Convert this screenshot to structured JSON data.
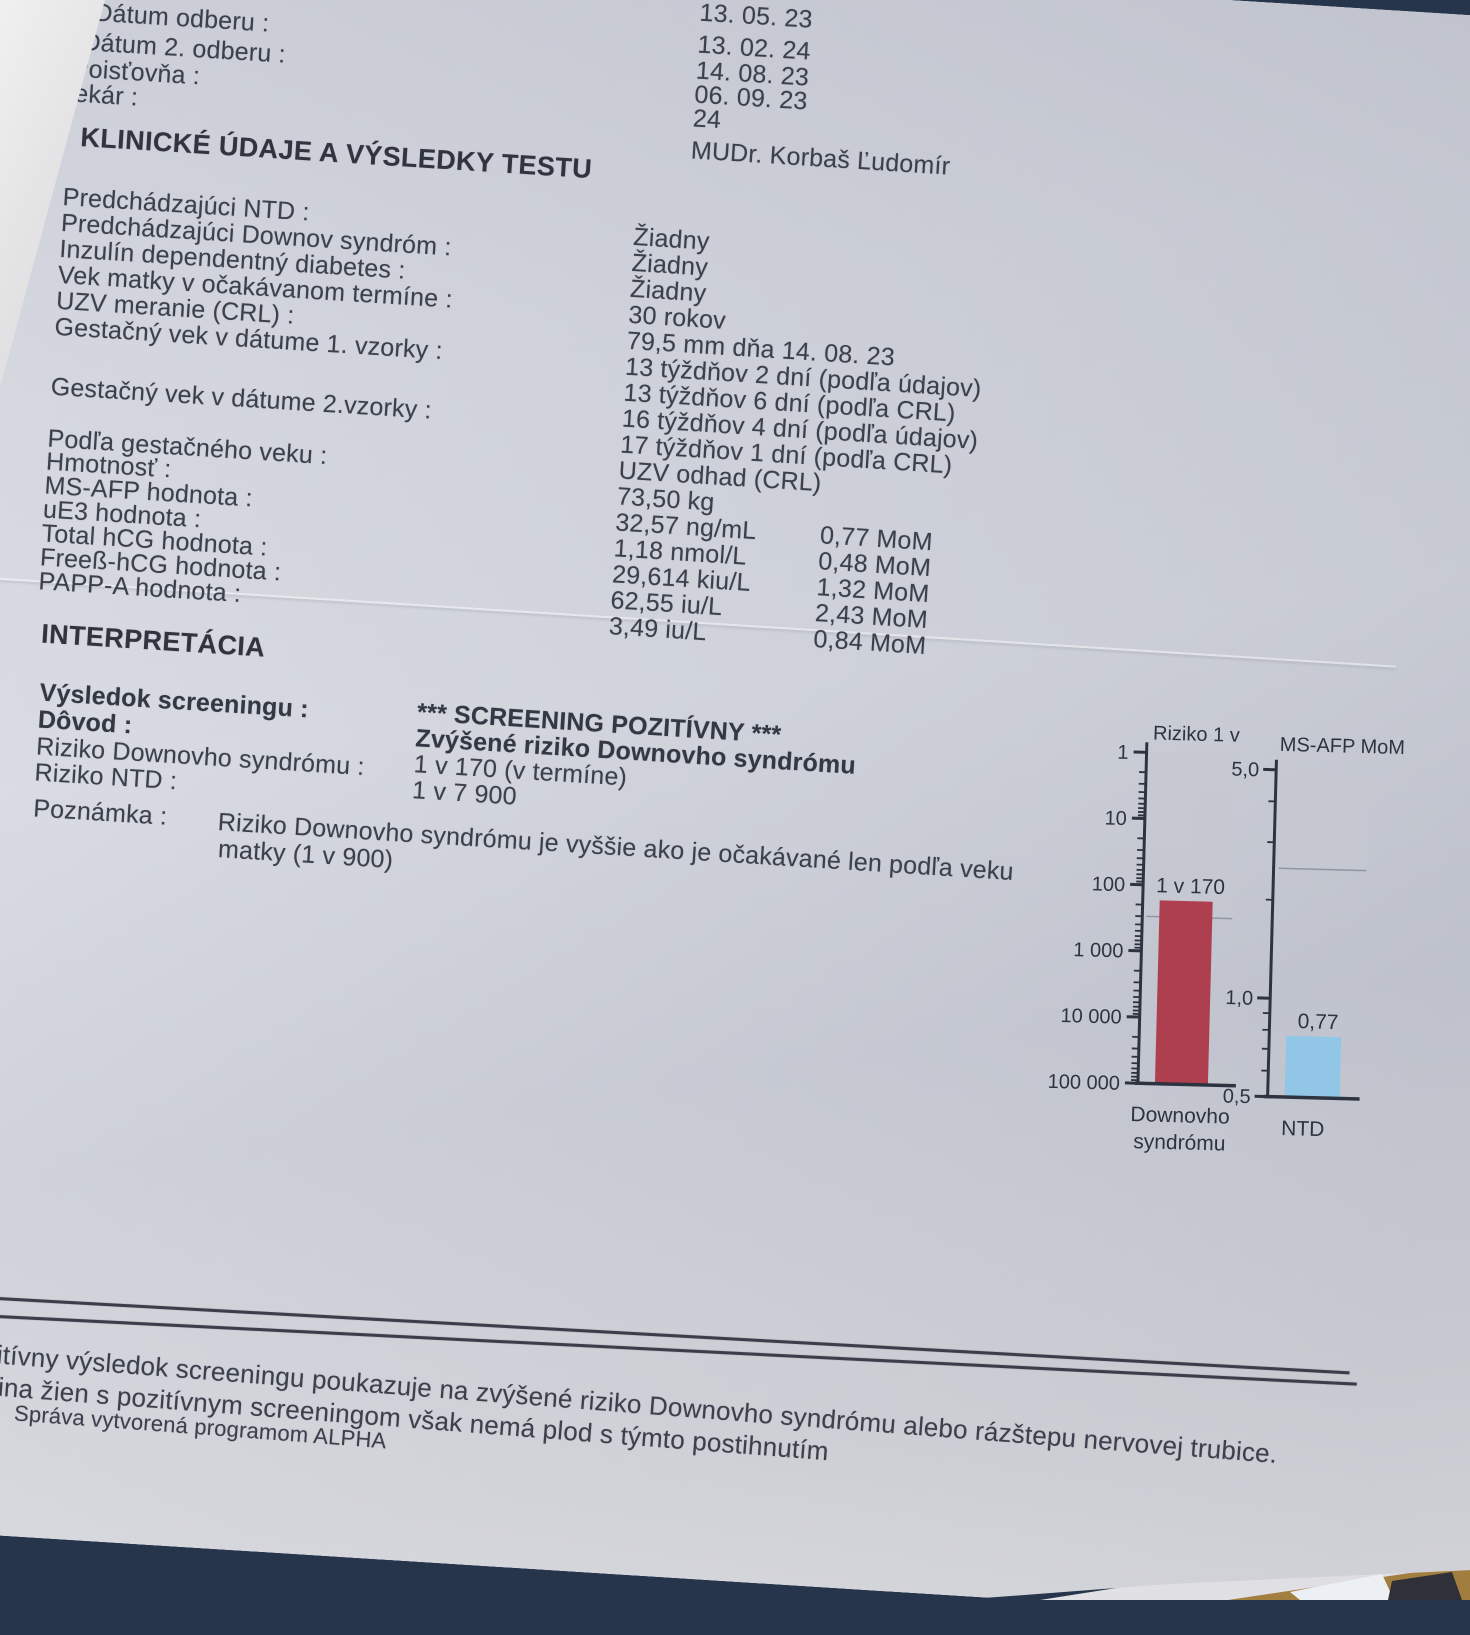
{
  "header": {
    "field_labels": [
      "Dátum odberu :",
      "Dátum 2. odberu :",
      "Poisťovňa :",
      "Lekár :"
    ],
    "field_values": [
      "13. 05. 23",
      "13. 02. 24",
      "14. 08. 23",
      "06. 09. 23",
      "24",
      "MUDr. Korbaš Ľudomír"
    ]
  },
  "clinical": {
    "section_title": "KLINICKÉ ÚDAJE A VÝSLEDKY TESTU",
    "labels": [
      "Predchádzajúci NTD :",
      "Predchádzajúci Downov syndróm :",
      "Inzulín dependentný diabetes :",
      "Vek matky v očakávanom termíne :",
      "UZV meranie (CRL) :",
      "Gestačný vek v dátume 1. vzorky :",
      "Gestačný vek v dátume 2.vzorky :",
      "Podľa gestačného veku :",
      "Hmotnosť :",
      "MS-AFP hodnota :",
      "uE3 hodnota :",
      "Total hCG hodnota :",
      "Freeß-hCG hodnota :",
      "PAPP-A hodnota :"
    ],
    "values": [
      "Žiadny",
      "Žiadny",
      "Žiadny",
      "30 rokov",
      "79,5 mm dňa 14. 08. 23",
      "13 týždňov 2 dní (podľa údajov)",
      "13 týždňov 6 dní (podľa CRL)",
      "16 týždňov 4 dní (podľa údajov)",
      "17 týždňov 1 dní (podľa CRL)",
      "UZV odhad (CRL)",
      "73,50 kg",
      "32,57 ng/mL",
      "1,18 nmol/L",
      "29,614 kiu/L",
      "62,55 iu/L",
      "3,49 iu/L"
    ],
    "mom_values": [
      "0,77 MoM",
      "0,48 MoM",
      "1,32 MoM",
      "2,43 MoM",
      "0,84 MoM"
    ]
  },
  "interpretation": {
    "section_title": "INTERPRETÁCIA",
    "row_labels": [
      "Výsledok screeningu :",
      "Dôvod :",
      "Riziko Downovho syndrómu :",
      "Riziko NTD :"
    ],
    "row_values": [
      "*** SCREENING POZITÍVNY ***",
      "Zvýšené riziko Downovho syndrómu",
      "1 v 170 (v termíne)",
      "1 v 7 900"
    ],
    "note_label": "Poznámka :",
    "note_line1": "Riziko Downovho syndrómu je vyššie ako je očakávané len podľa veku",
    "note_line2": "matky (1 v 900)"
  },
  "chart_data": [
    {
      "type": "bar",
      "title": "Riziko  1 v",
      "categories": [
        "Downovho syndrómu"
      ],
      "values": [
        170
      ],
      "value_labels": [
        "1 v 170"
      ],
      "scale": "log",
      "axis_range": [
        1,
        100000
      ],
      "ticks": [
        {
          "v": 1,
          "label": "1"
        },
        {
          "v": 10,
          "label": "10"
        },
        {
          "v": 100,
          "label": "100"
        },
        {
          "v": 1000,
          "label": "1 000"
        },
        {
          "v": 10000,
          "label": "10 000"
        },
        {
          "v": 100000,
          "label": "100 000"
        }
      ],
      "shaded_region": [
        1,
        300
      ],
      "baseline": 100000,
      "bar_color": "#ae3f4e",
      "shade_color": "#c5c8d1",
      "xlabel_lines": [
        "Downovho",
        "syndrómu"
      ]
    },
    {
      "type": "bar",
      "title": "MS-AFP MoM",
      "categories": [
        "NTD"
      ],
      "values": [
        0.77
      ],
      "value_labels": [
        "0,77"
      ],
      "scale": "log",
      "axis_range": [
        5,
        0.5
      ],
      "ticks": [
        {
          "v": 5,
          "label": "5,0"
        },
        {
          "v": 1,
          "label": "1,0"
        },
        {
          "v": 0.5,
          "label": "0,5"
        }
      ],
      "shaded_region": [
        5,
        2.5
      ],
      "baseline": 0.5,
      "bar_color": "#92c6e6",
      "shade_color": "#c5c8d1",
      "xlabel_lines": [
        "NTD"
      ]
    }
  ],
  "footer": {
    "line1": "zitívny výsledok screeningu poukazuje na zvýšené riziko Downovho syndrómu alebo rázštepu nervovej trubice.",
    "line2": "čšina žien s pozitívnym screeningom však nemá plod s týmto postihnutím",
    "credit": "Správa vytvorená programom ALPHA"
  }
}
